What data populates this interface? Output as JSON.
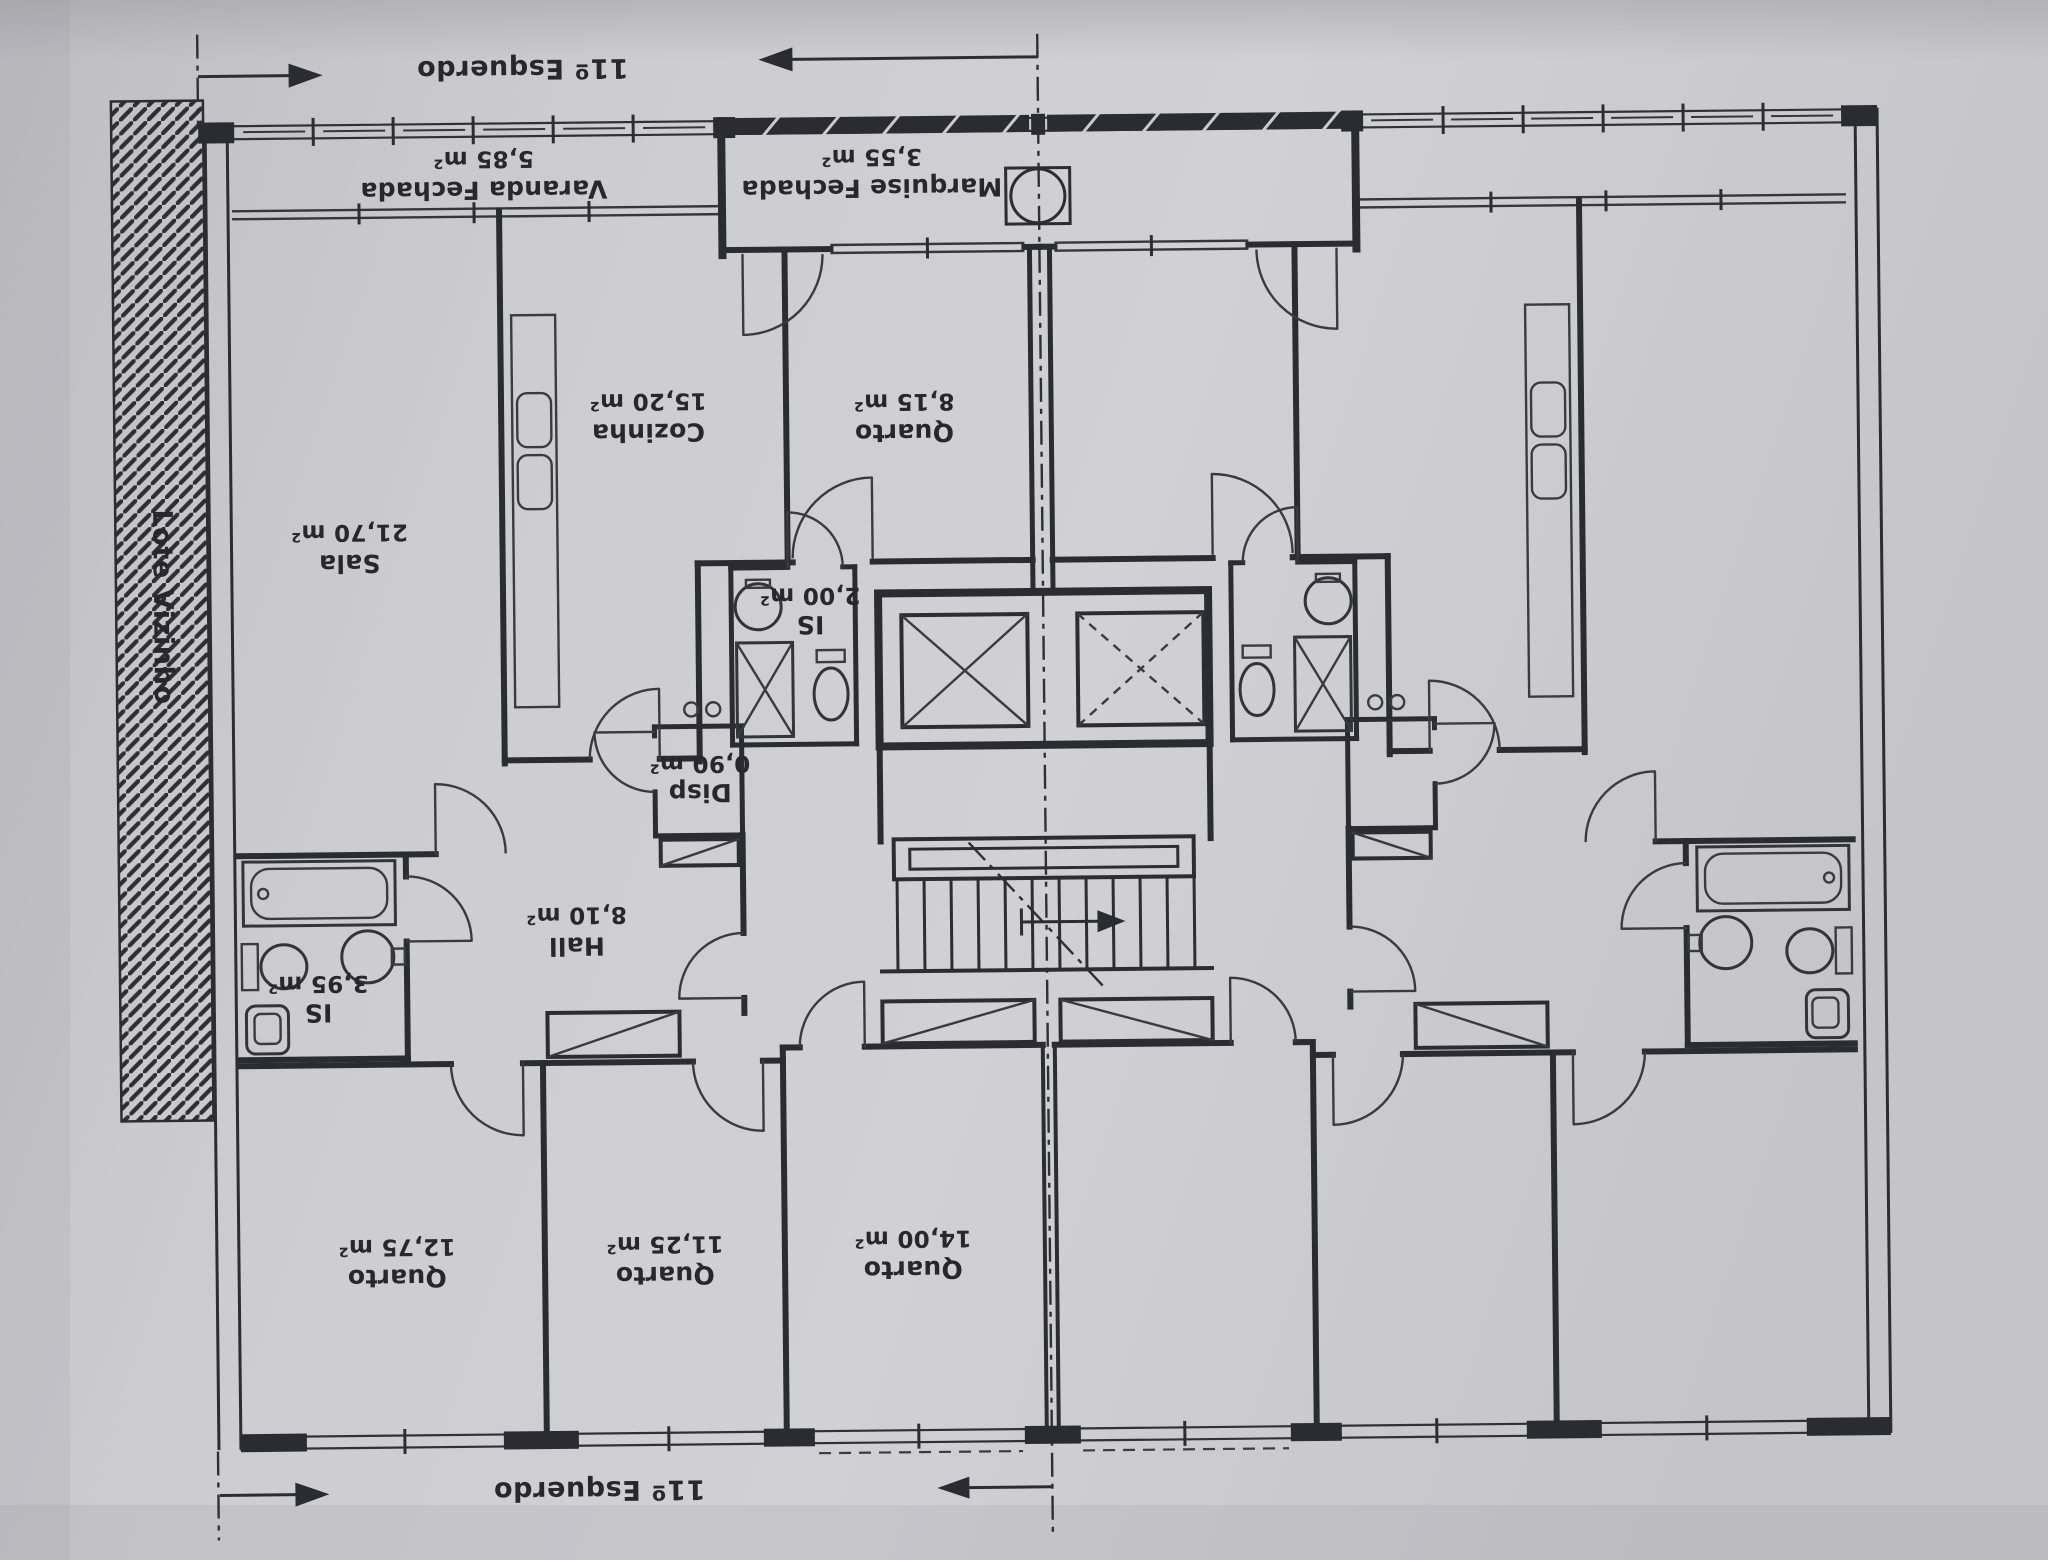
{
  "drawing": {
    "unit_top_label": "11º Esquerdo",
    "unit_bottom_label": "11º Esquerdo",
    "neighbor_lot_label": "Lote Vizinho",
    "rooms": {
      "varanda": {
        "name": "Varanda Fechada",
        "area": "5,85 m²"
      },
      "marquise": {
        "name": "Marquise Fechada",
        "area": "3,55 m²"
      },
      "sala": {
        "name": "Sala",
        "area": "21,70 m²"
      },
      "cozinha": {
        "name": "Cozinha",
        "area": "15,20 m²"
      },
      "quarto_815": {
        "name": "Quarto",
        "area": "8,15 m²"
      },
      "is_200": {
        "name": "IS",
        "area": "2,00 m²"
      },
      "disp": {
        "name": "Disp",
        "area": "0,90 m²"
      },
      "hall": {
        "name": "Hall",
        "area": "8,10 m²"
      },
      "is_395": {
        "name": "IS",
        "area": "3,95 m²"
      },
      "quarto_1275": {
        "name": "Quarto",
        "area": "12,75 m²"
      },
      "quarto_1125": {
        "name": "Quarto",
        "area": "11,25 m²"
      },
      "quarto_1400": {
        "name": "Quarto",
        "area": "14,00 m²"
      }
    },
    "colors": {
      "paper": "#cbcbcf",
      "ink": "#2b2b32"
    }
  }
}
